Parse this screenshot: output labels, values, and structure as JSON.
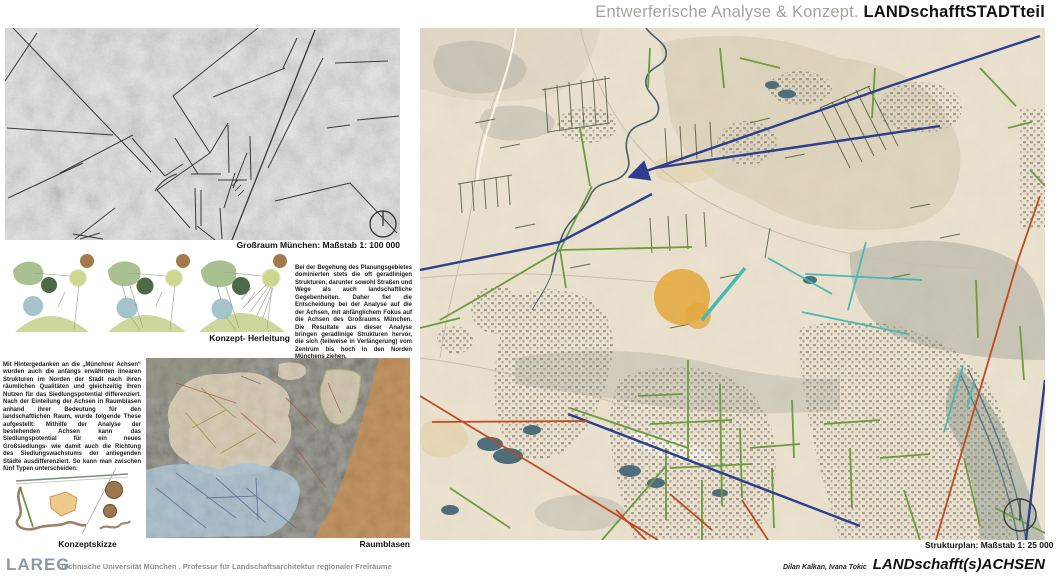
{
  "header": {
    "title_light": "Entwerferische Analyse & Konzept. ",
    "title_bold": "LANDschafftSTADTteil"
  },
  "left": {
    "grossraum_caption": "Großraum München: Maßstab 1: 100 000",
    "herleitung_caption": "Konzept- Herleitung",
    "paragraph1": "Bei der Begehung des Planungsgebietes dominierten stets die oft geradlinigen Strukturen, darunter sowohl Straßen und Wege als auch landschaftliche Gegebenheiten. Daher fiel die Entscheidung bei der Analyse auf die der Achsen, mit anfänglichem Fokus auf die Achsen des Großraums München. Die Resultate aus dieser Analyse bringen geradlinige Strukturen hervor, die sich (teilweise in Verlängerung) vom Zentrum bis hoch in den Norden Münchens ziehen.",
    "paragraph2": "Mit Hintergedanken an die „Münchner Achsen“ wurden auch die anfangs erwähnten linearen Strukturen im Norden der Stadt nach ihren räumlichen Qualitäten und gleichzeitig ihren Nutzen für das Siedlungspotential differenziert. Nach der Einteilung der Achsen in Raumblasen anhand ihrer Bedeutung für den landschaftlichen Raum, wurde folgende These aufgestellt: Mithilfe der Analyse der bestehenden Achsen kann das Siedlungspotential für ein neues Großsiedlungs- wie damit auch die Richtung des Siedlungswachstums der anliegenden Städte ausdifferenziert. So kann man zwischen fünf Typen unterscheiden:",
    "konzeptskizze_caption": "Konzeptskizze",
    "raumblasen_caption": "Raumblasen"
  },
  "right": {
    "strukturplan_caption": "Strukturplan: Maßstab 1: 25 000"
  },
  "footer": {
    "logo": "LAREG",
    "institution": "Technische Universität München . Professur für Landschaftsarchitektur regionaler Freiräume",
    "authors": "Dilan Kalkan, Ivana Tokic",
    "project": "LANDschafft(s)ACHSEN"
  },
  "icons": {
    "north_arrow": "north-arrow-icon",
    "compass": "compass-icon"
  },
  "colors": {
    "axis_navy": "#2d3f8e",
    "axis_green": "#6b9c3e",
    "axis_teal": "#49b8b2",
    "axis_red": "#c04a1e",
    "highlight_orange": "#e3a83f",
    "title_gray": "#a3a39e",
    "logo_blue_gray": "#8b99a6"
  }
}
